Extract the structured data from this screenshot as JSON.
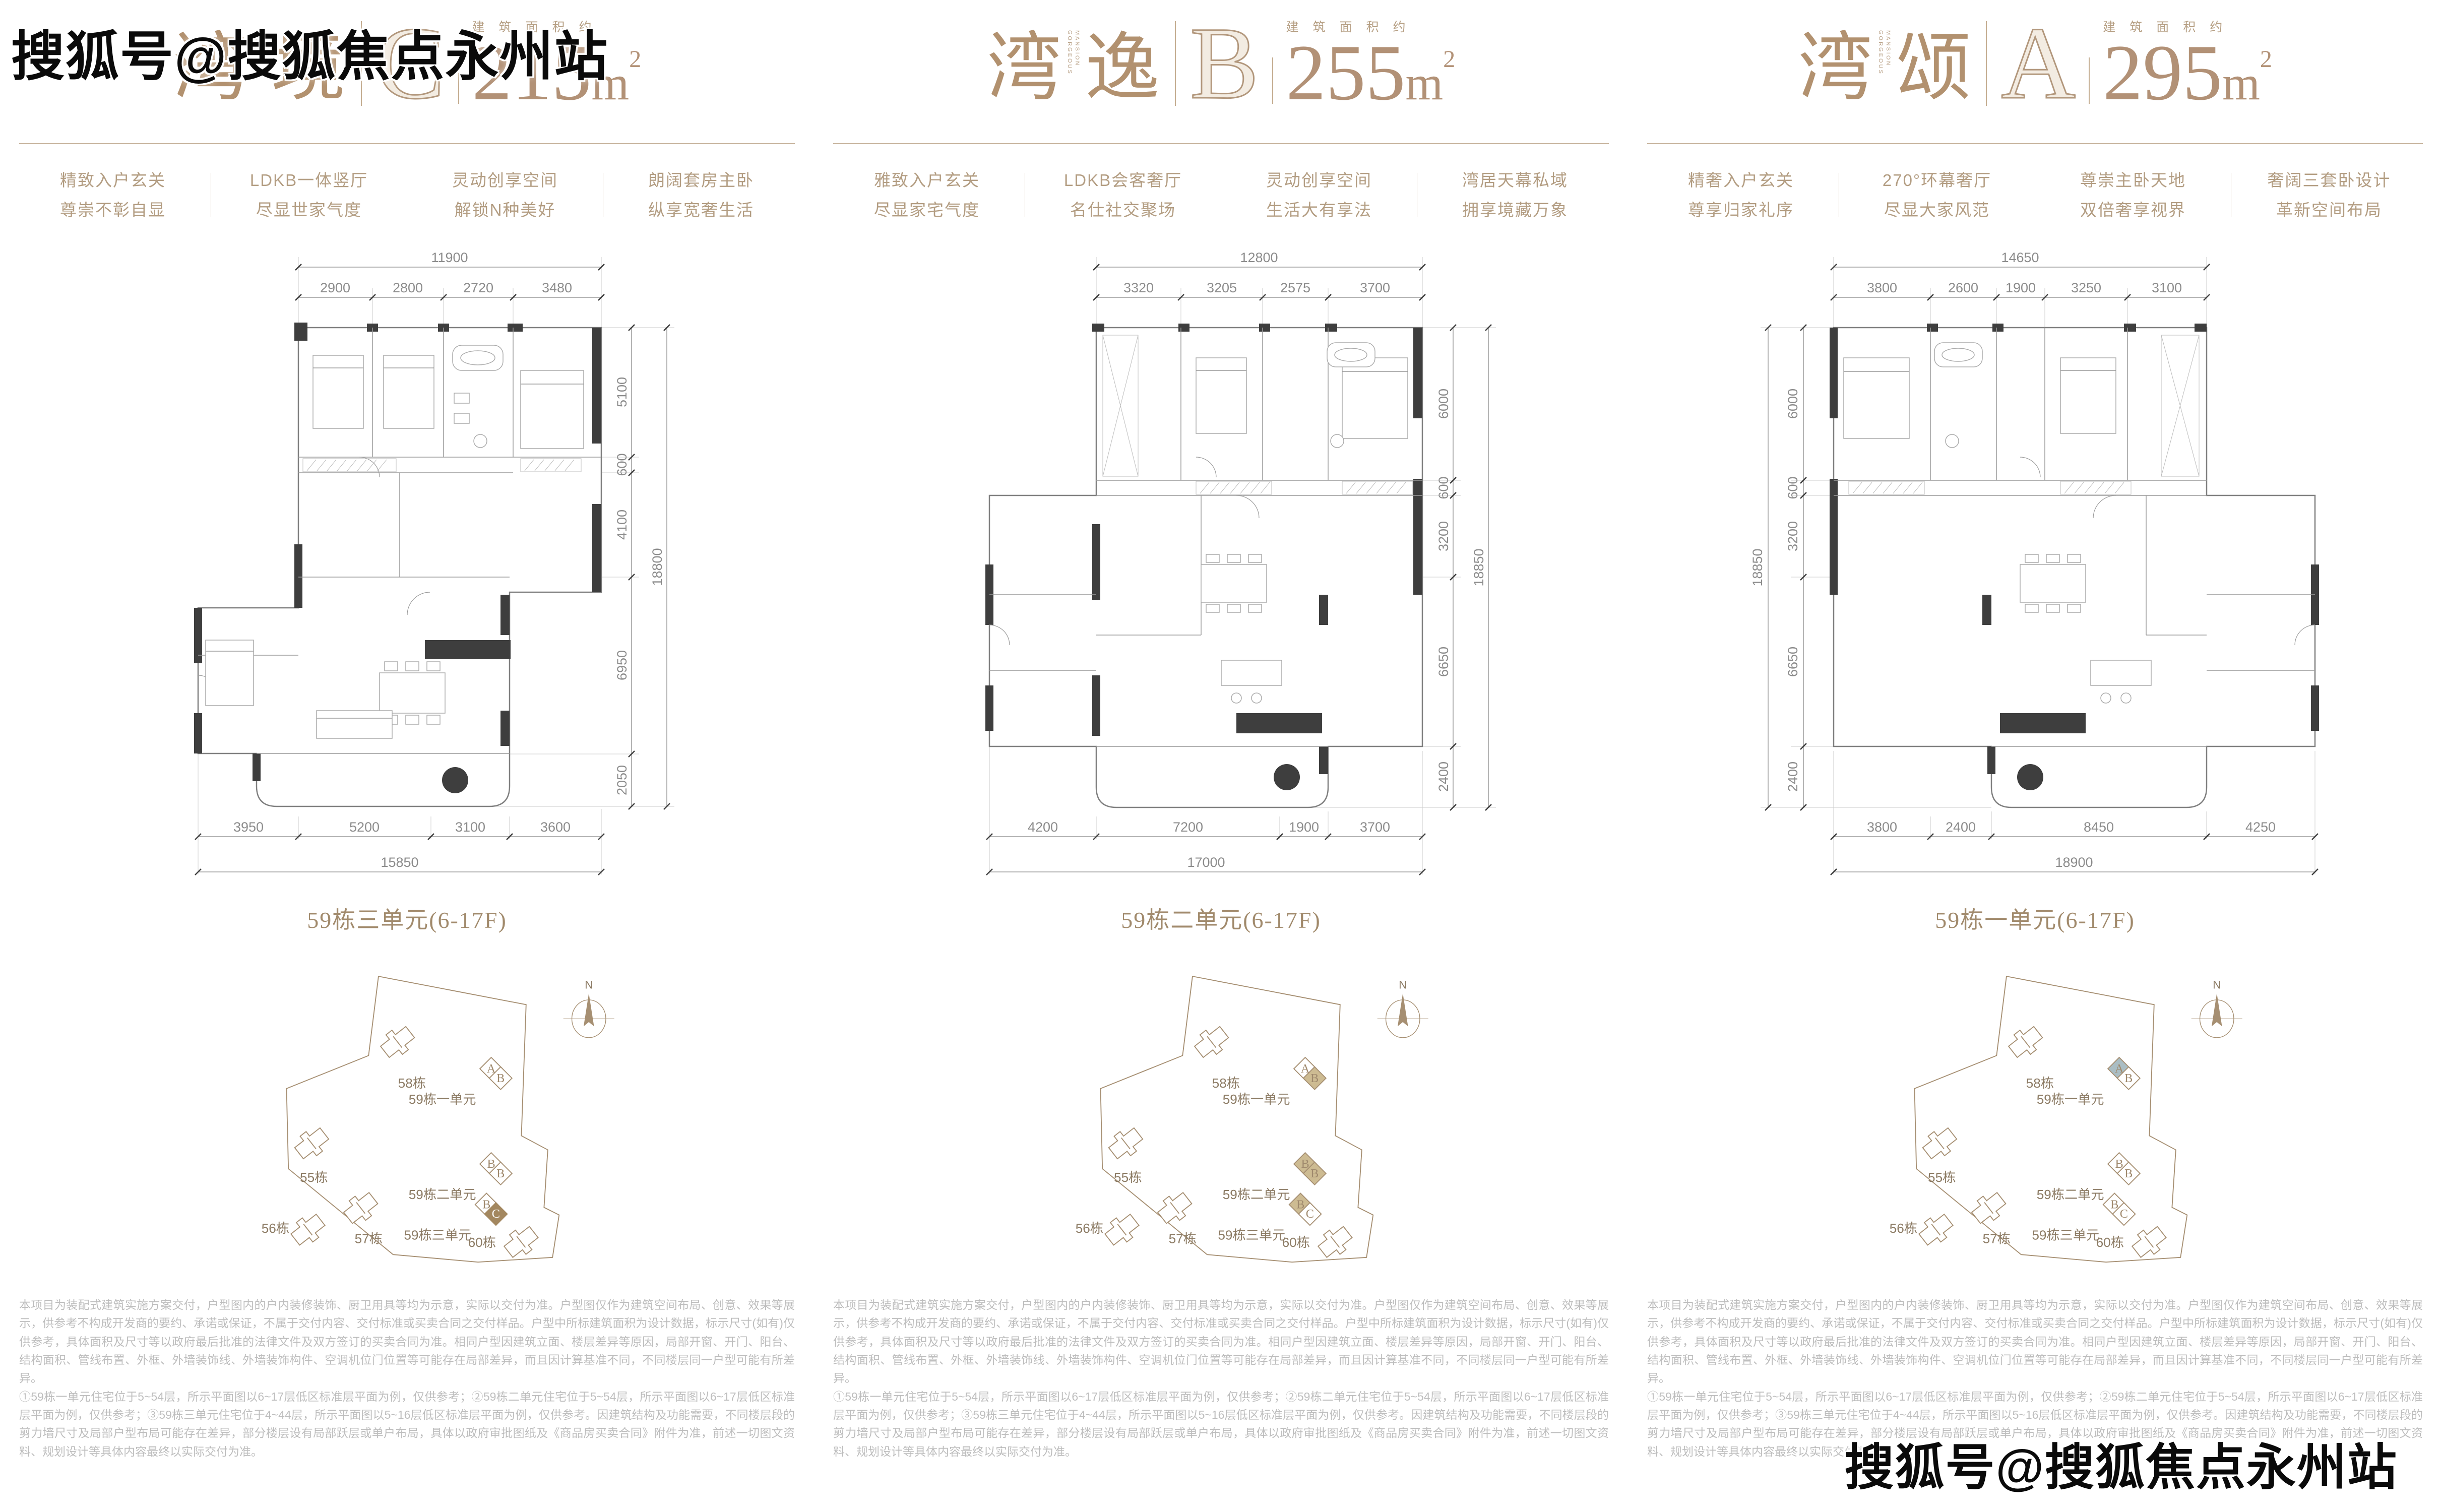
{
  "watermark": {
    "text": "搜狐号@搜狐焦点永州站"
  },
  "site": {
    "north": "N",
    "buildings": [
      "58栋",
      "55栋",
      "57栋",
      "56栋",
      "60栋"
    ],
    "units": [
      {
        "label": "59栋一单元",
        "cells": [
          "A",
          "B"
        ]
      },
      {
        "label": "59栋二单元",
        "cells": [
          "B",
          "B"
        ]
      },
      {
        "label": "59栋三单元",
        "cells": [
          "B",
          "C"
        ]
      }
    ]
  },
  "disclaimer": {
    "p1": "本项目为装配式建筑实施方案交付，户型图内的户内装修装饰、厨卫用具等均为示意，实际以交付为准。户型图仅作为建筑空间布局、创意、效果等展示，供参考不构成开发商的要约、承诺或保证，不属于交付内容、交付标准或买卖合同之交付样品。户型中所标建筑面积为设计数据，标示尺寸(如有)仅供参考，具体面积及尺寸等以政府最后批准的法律文件及双方签订的买卖合同为准。相同户型因建筑立面、楼层差异等原因，局部开窗、开门、阳台、结构面积、管线布置、外框、外墙装饰线、外墙装饰构件、空调机位门位置等可能存在局部差异，而且因计算基准不同，不同楼层同一户型可能有所差异。",
    "p2": "①59栋一单元住宅位于5~54层，所示平面图以6~17层低区标准层平面为例，仅供参考；②59栋二单元住宅位于5~54层，所示平面图以6~17层低区标准层平面为例，仅供参考；③59栋三单元住宅位于4~44层，所示平面图以5~16层低区标准层平面为例，仅供参考。因建筑结构及功能需要，不同楼层段的剪力墙尺寸及局部户型布局可能存在差异，部分楼层设有局部跃层或单户布局，具体以政府审批图纸及《商品房买卖合同》附件为准，前述一切图文资料、规划设计等具体内容最终以实际交付为准。"
  },
  "panels": [
    {
      "title": {
        "cn1": "湾",
        "cn2": "境",
        "en1": "GORGEOUS",
        "en2": "MANSION",
        "letter": "C",
        "area_label": "建筑面积约",
        "area_number": "215",
        "area_unit": "m",
        "area_sup": "2"
      },
      "features": [
        [
          "精致入户玄关",
          "尊崇不彰自显"
        ],
        [
          "LDKB一体竖厅",
          "尽显世家气度"
        ],
        [
          "灵动创享空间",
          "解锁N种美好"
        ],
        [
          "朗阔套房主卧",
          "纵享宽奢生活"
        ]
      ],
      "dims": {
        "top_total": "11900",
        "top_segments": [
          "2900",
          "2800",
          "2720",
          "3480"
        ],
        "side_segments": [
          "5100",
          "600",
          "4100",
          "6950",
          "2050"
        ],
        "side_total": "18800",
        "bottom_segments": [
          "3950",
          "5200",
          "3100",
          "3600"
        ],
        "bottom_total": "15850"
      },
      "plan_label": "59栋三单元(6-17F)"
    },
    {
      "title": {
        "cn1": "湾",
        "cn2": "逸",
        "en1": "GORGEOUS",
        "en2": "MANSION",
        "letter": "B",
        "area_label": "建筑面积约",
        "area_number": "255",
        "area_unit": "m",
        "area_sup": "2"
      },
      "features": [
        [
          "雅致入户玄关",
          "尽显家宅气度"
        ],
        [
          "LDKB会客奢厅",
          "名仕社交聚场"
        ],
        [
          "灵动创享空间",
          "生活大有享法"
        ],
        [
          "湾居天幕私域",
          "拥享境藏万象"
        ]
      ],
      "dims": {
        "top_total": "12800",
        "top_segments": [
          "3320",
          "3205",
          "2575",
          "3700"
        ],
        "side_segments": [
          "6000",
          "600",
          "3200",
          "6650",
          "2400"
        ],
        "side_total": "18850",
        "bottom_segments": [
          "4200",
          "7200",
          "1900",
          "3700"
        ],
        "bottom_total": "17000"
      },
      "plan_label": "59栋二单元(6-17F)"
    },
    {
      "title": {
        "cn1": "湾",
        "cn2": "颂",
        "en1": "GORGEOUS",
        "en2": "MANSION",
        "letter": "A",
        "area_label": "建筑面积约",
        "area_number": "295",
        "area_unit": "m",
        "area_sup": "2"
      },
      "features": [
        [
          "精奢入户玄关",
          "尊享归家礼序"
        ],
        [
          "270°环幕奢厅",
          "尽显大家风范"
        ],
        [
          "尊崇主卧天地",
          "双倍奢享视界"
        ],
        [
          "奢阔三套卧设计",
          "革新空间布局"
        ]
      ],
      "dims": {
        "top_total": "14650",
        "top_segments": [
          "3800",
          "2600",
          "1900",
          "3250",
          "3100"
        ],
        "side_segments": [
          "6000",
          "600",
          "3200",
          "6650",
          "2400"
        ],
        "side_total": "18850",
        "bottom_segments": [
          "3800",
          "2400",
          "8450",
          "4250"
        ],
        "bottom_total": "18900"
      },
      "plan_label": "59栋一单元(6-17F)"
    }
  ]
}
